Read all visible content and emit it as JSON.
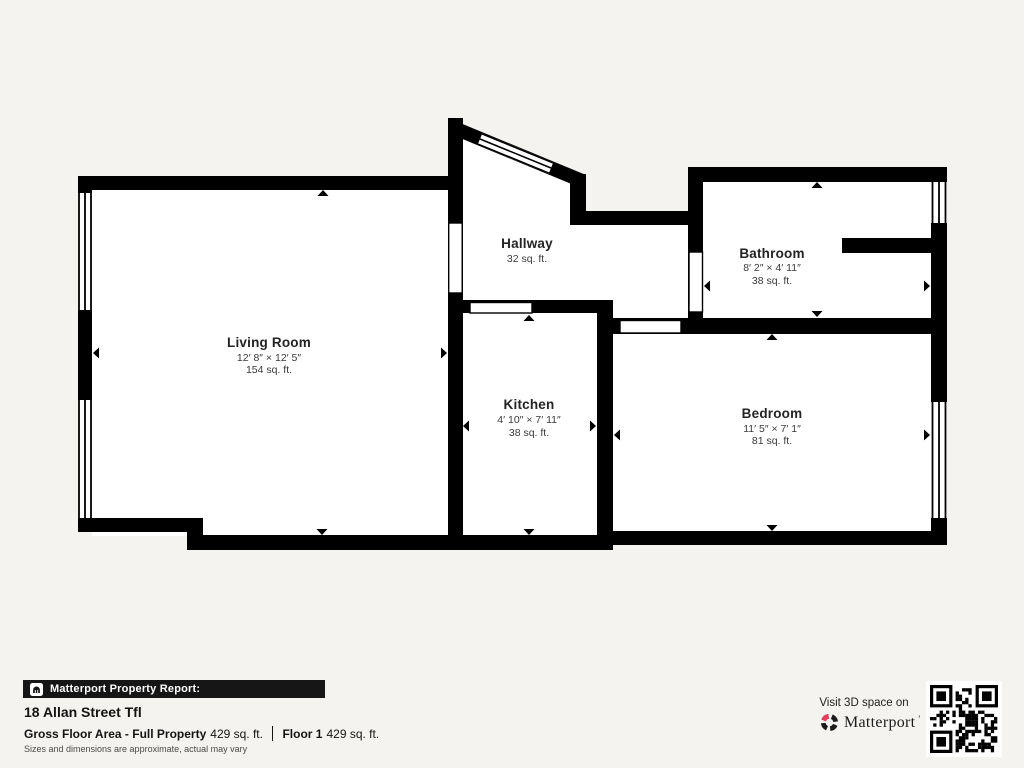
{
  "floorplan": {
    "rooms": [
      {
        "name": "Living Room",
        "dimensions": "12′ 8″ × 12′ 5″",
        "area": "154 sq. ft."
      },
      {
        "name": "Hallway",
        "dimensions": "",
        "area": "32 sq. ft."
      },
      {
        "name": "Kitchen",
        "dimensions": "4′ 10″ × 7′ 11″",
        "area": "38 sq. ft."
      },
      {
        "name": "Bathroom",
        "dimensions": "8′ 2″ × 4′ 11″",
        "area": "38 sq. ft."
      },
      {
        "name": "Bedroom",
        "dimensions": "11′ 5″ × 7′ 1″",
        "area": "81 sq. ft."
      }
    ]
  },
  "footer": {
    "report_label": "Matterport Property Report:",
    "address": "18 Allan Street Tfl",
    "gross_floor_area_label": "Gross Floor Area - Full Property",
    "gross_floor_area_value": "429 sq. ft.",
    "floor_label": "Floor 1",
    "floor_value": "429 sq. ft.",
    "disclaimer": "Sizes and dimensions are approximate, actual may vary"
  },
  "cta": {
    "visit_text": "Visit 3D space on",
    "brand": "Matterport",
    "brand_mark": "'"
  },
  "colors": {
    "wall": "#000000",
    "floor": "#ffffff",
    "background": "#f4f3f0",
    "brand_red": "#ee3c5e"
  }
}
